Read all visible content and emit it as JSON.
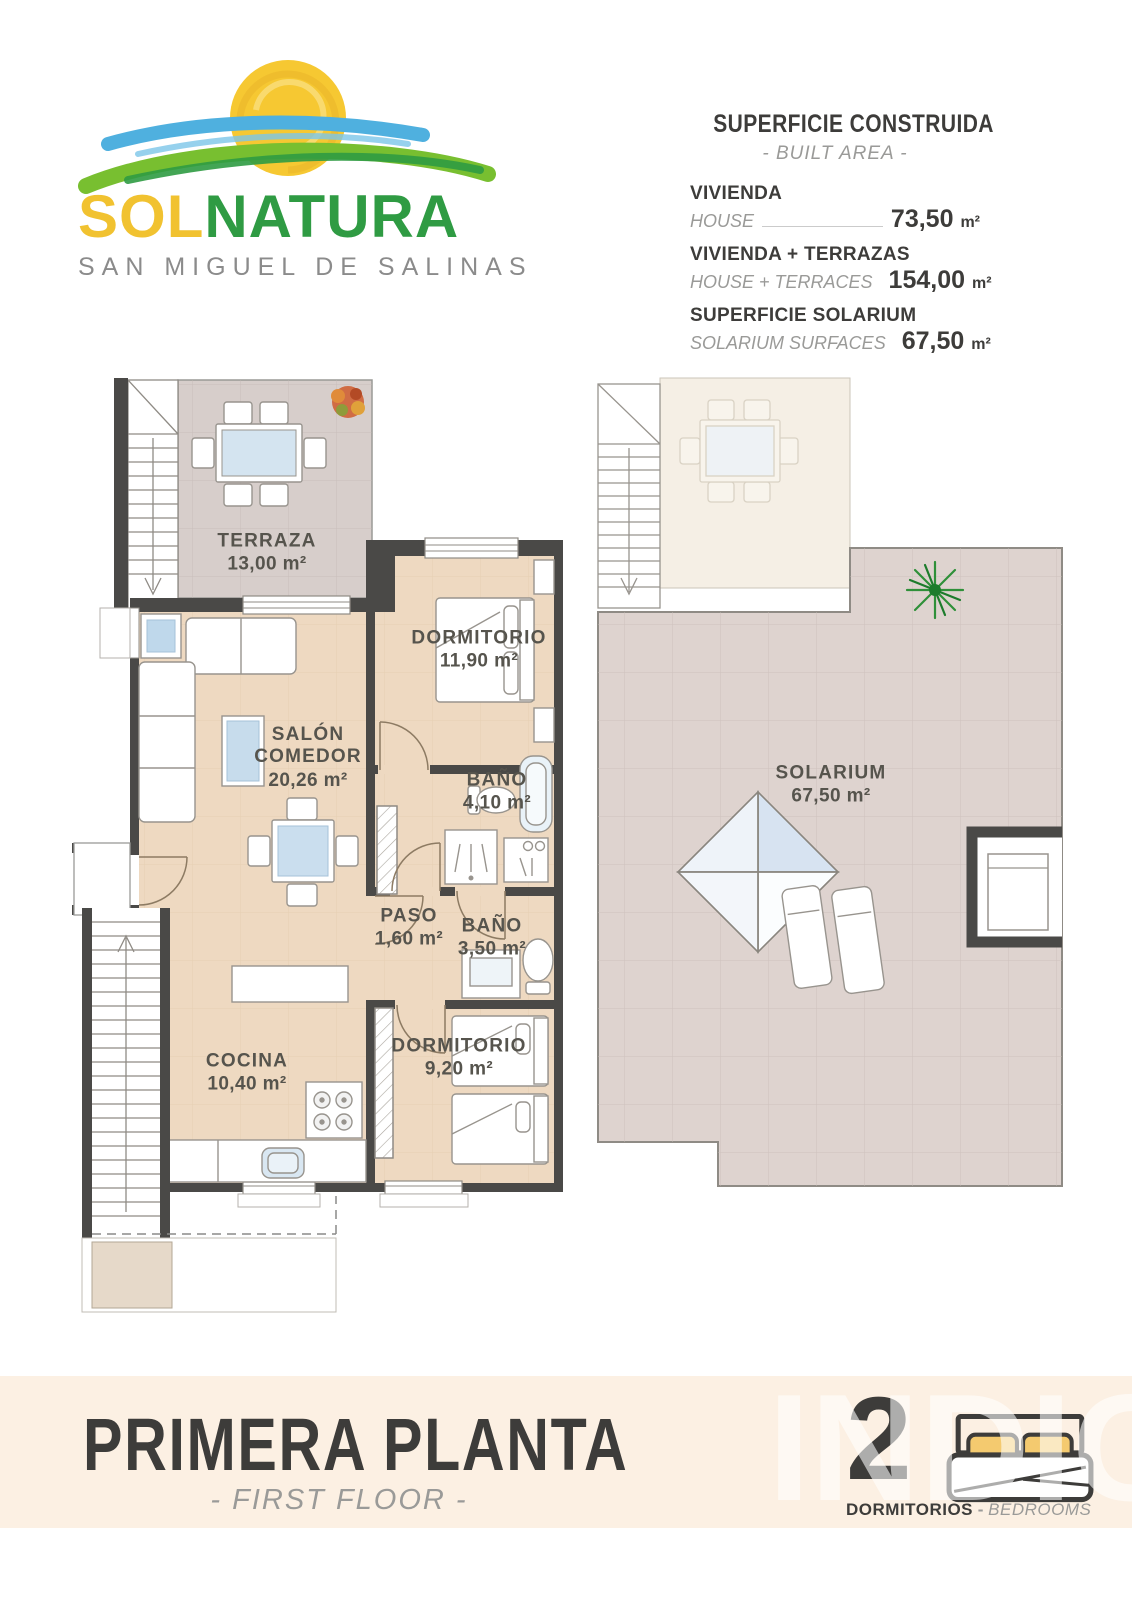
{
  "logo": {
    "sol": "SOL",
    "natura": "NATURA",
    "subtitle": "SAN MIGUEL DE SALINAS"
  },
  "built_area": {
    "title": "SUPERFICIE CONSTRUIDA",
    "subtitle": "- BUILT AREA -",
    "rows": [
      {
        "label_es": "VIVIENDA",
        "label_en": "HOUSE",
        "value": "73,50",
        "unit": "m²"
      },
      {
        "label_es": "VIVIENDA + TERRAZAS",
        "label_en": "HOUSE + TERRACES",
        "value": "154,00",
        "unit": "m²"
      },
      {
        "label_es": "SUPERFICIE SOLARIUM",
        "label_en": "SOLARIUM SURFACES",
        "value": "67,50",
        "unit": "m²"
      }
    ]
  },
  "rooms": [
    {
      "name": "TERRAZA",
      "area": "13,00 m²"
    },
    {
      "name": "DORMITORIO",
      "area": "11,90 m²"
    },
    {
      "name": "SALÓN\nCOMEDOR",
      "area": "20,26 m²"
    },
    {
      "name": "BAÑO",
      "area": "4,10 m²"
    },
    {
      "name": "PASO",
      "area": "1,60 m²"
    },
    {
      "name": "BAÑO",
      "area": "3,50 m²"
    },
    {
      "name": "DORMITORIO",
      "area": "9,20 m²"
    },
    {
      "name": "COCINA",
      "area": "10,40 m²"
    },
    {
      "name": "SOLARIUM",
      "area": "67,50 m²"
    }
  ],
  "footer": {
    "title": "PRIMERA PLANTA",
    "subtitle": "- FIRST FLOOR -",
    "bedrooms_count": "2",
    "bedrooms_es": "DORMITORIOS",
    "separator": "-",
    "bedrooms_en": "BEDROOMS",
    "watermark": "INDIGO"
  },
  "palette": {
    "wall": "#4a4947",
    "floor": "#eed9c1",
    "terrace_floor": "#d7cecb",
    "solarium_floor": "#ded3cf",
    "band_bg": "#fcf0e3",
    "accent_yellow": "#f1c230",
    "accent_green": "#2f9b43",
    "accent_blue": "#4fb0df",
    "text_dark": "#3d3c3a",
    "text_gray": "#9a9a98",
    "pillow_yellow": "#f4ca6f"
  }
}
